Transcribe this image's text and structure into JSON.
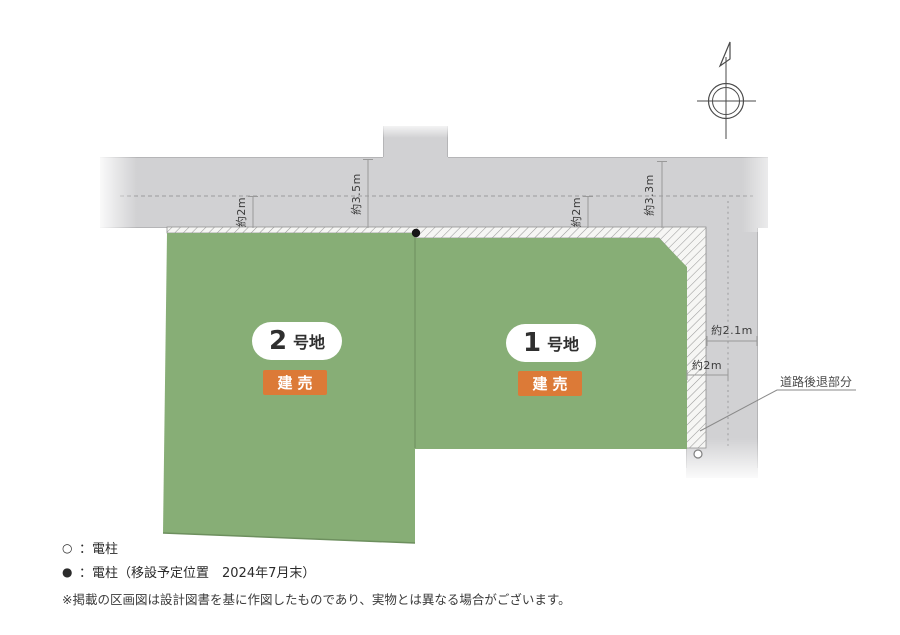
{
  "plan": {
    "dimensions": {
      "top": [
        {
          "label": "約2m"
        },
        {
          "label": "約3.5m"
        },
        {
          "label": "約2m"
        },
        {
          "label": "約3.3m"
        }
      ],
      "side": [
        {
          "label": "約2.1m"
        },
        {
          "label": "約2m"
        }
      ]
    },
    "setback_label": "道路後退部分",
    "lots": [
      {
        "number": "2",
        "suffix": "号地",
        "badge": "建売"
      },
      {
        "number": "1",
        "suffix": "号地",
        "badge": "建売"
      }
    ],
    "compass": {
      "icon": "north-arrow-icon"
    }
  },
  "legend": {
    "items": [
      {
        "symbol": "○",
        "text": "：電柱"
      },
      {
        "symbol": "●",
        "text": "：電柱（移設予定位置　2024年7月末）"
      }
    ]
  },
  "disclaimer": "※掲載の区画図は設計図書を基に作図したものであり、実物とは異なる場合がございます。",
  "colors": {
    "lot_green": "#87ae76",
    "road_gray": "#d1d1d3",
    "badge_orange": "#dc7a37",
    "hatch_line": "#9a9a9a"
  }
}
